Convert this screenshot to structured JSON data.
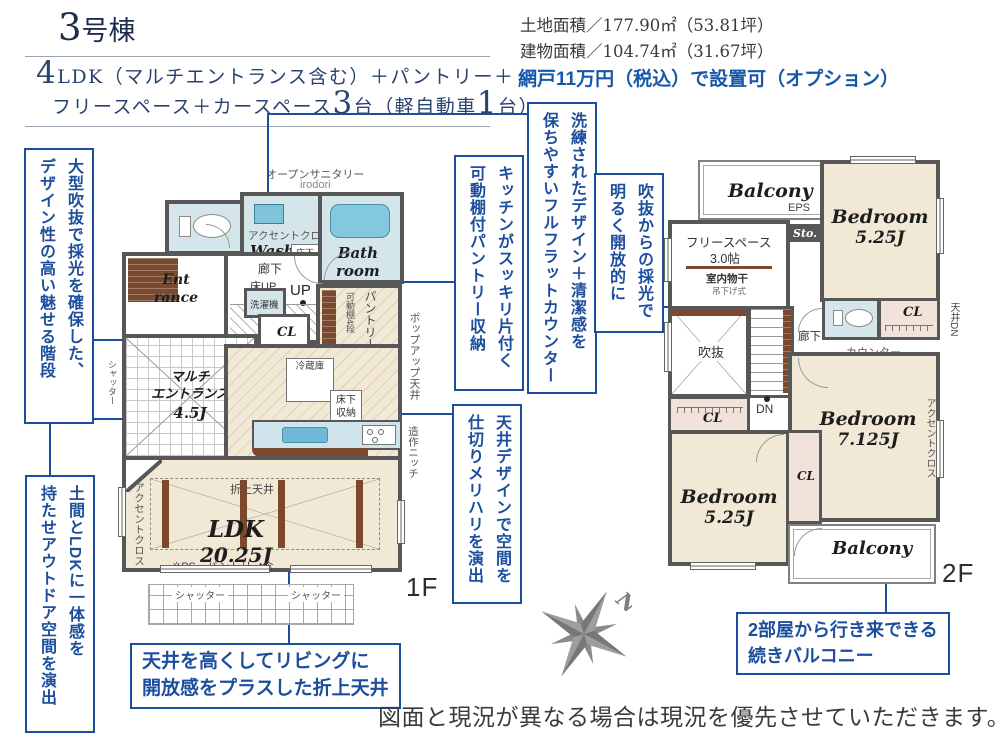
{
  "header": {
    "building_num": "3",
    "building_suffix": "号棟",
    "spec": {
      "p1": "4",
      "p2": "LDK（マルチエントランス含む）＋パントリー＋",
      "p3": "フリースペース＋カースペース",
      "p4": "3",
      "p5": "台（軽自動車",
      "p6": "1",
      "p7": "台）"
    },
    "land_area": "土地面積／177.90㎡（53.81坪）",
    "building_area": "建物面積／104.74㎡（31.67坪）",
    "option_note": "網戸11万円（税込）で設置可（オプション）"
  },
  "callouts": {
    "stairs": {
      "line1": "大型吹抜で採光を確保した、",
      "line2": "デザイン性の高い魅せる階段"
    },
    "doma": {
      "line1": "土間とLDKに一体感を",
      "line2": "持たせアウトドア空間を演出"
    },
    "counter": {
      "line1": "洗練されたデザイン＋清潔感を",
      "line2": "保ちやすいフルフラットカウンター"
    },
    "pantry": {
      "line1": "キッチンがスッキリ片付く",
      "line2": "可動棚付パントリー収納"
    },
    "ceiling": {
      "line1": "天井デザインで空間を",
      "line2": "仕切りメリハリを演出"
    },
    "void": {
      "line1": "吹抜からの採光で",
      "line2": "明るく開放的に"
    },
    "living": {
      "line1": "天井を高くしてリビングに",
      "line2": "開放感をプラスした折上天井"
    },
    "balcony": {
      "line1": "2部屋から行き来できる",
      "line2": "続きバルコニー"
    }
  },
  "floor1": {
    "label": "1F",
    "open_sanitary": "オープンサニタリー",
    "open_sanitary_sub": "irodori",
    "accent_cloth": "アクセントクロス",
    "wash_l1": "Wash",
    "wash_l2": "room",
    "bath_l1": "Bath",
    "bath_l2": "room",
    "underfloor_l1": "床下",
    "underfloor_l2": "収納",
    "washer": "洗濯機",
    "entrance_l1": "Ent",
    "entrance_l2": "rance",
    "hallway": "廊下",
    "floor_up": "床UP",
    "up": "UP",
    "multi_l1": "マルチ",
    "multi_l2": "エントランス",
    "multi_l3": "4.5J",
    "cl": "CL",
    "ps": "PS",
    "pantry_v": "パントリー",
    "pantry_shelf": "可動棚4段",
    "fridge": "冷蔵庫",
    "popup_ceiling": "ポップアップ天井",
    "niche": "造作ニッチ",
    "oriage": "折上天井",
    "ldk": "LDK",
    "ldk_size": "20.25J",
    "ldk_note": "※PS・パントリー含",
    "shutter": "シャッター"
  },
  "floor2": {
    "label": "2F",
    "balcony": "Balcony",
    "eps": "EPS",
    "sto": "Sto.",
    "free_space": "フリースペース",
    "free_space_size": "3.0帖",
    "indoor_drying": "室内物干",
    "hanging": "吊下げ式",
    "bedroom": "Bedroom",
    "bedroom1_size": "5.25J",
    "bedroom2_size": "7.125J",
    "bedroom3_size": "5.25J",
    "void": "吹抜",
    "dn": "DN",
    "hallway": "廊下",
    "counter": "カウンター",
    "cl": "CL",
    "accent_cloth": "アクセントクロス",
    "ceiling_dn": "天井DN"
  },
  "compass": {
    "north": "N"
  },
  "footer": {
    "disclaimer": "図面と現況が異なる場合は現況を優先させていただきます。"
  },
  "colors": {
    "accent": "#1d4e9e",
    "wall": "#575757",
    "room_beige": "#f1e9d6",
    "water_blue": "#d5e6eb",
    "fixture_blue": "#7fc4da",
    "wood_brown": "#7b4a2e",
    "closet_pink": "#f2e3da"
  }
}
